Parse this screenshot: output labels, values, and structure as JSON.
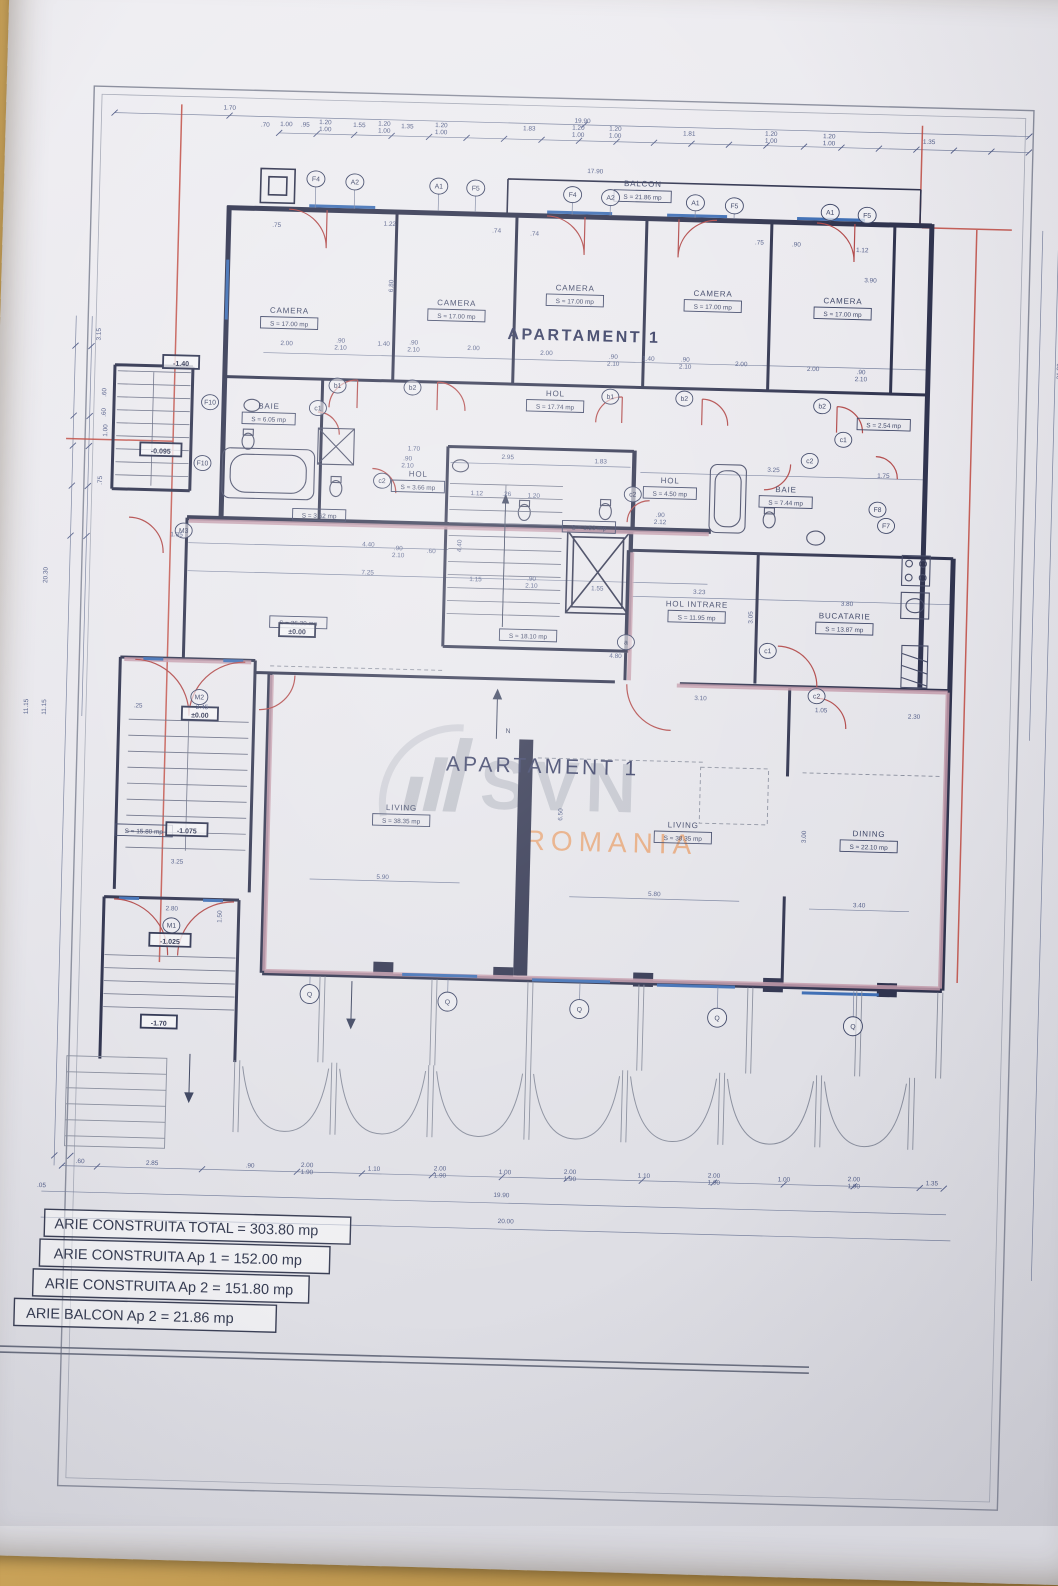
{
  "titles": {
    "upper": "APARTAMENT 1",
    "lower": "APARTAMENT 1"
  },
  "watermark": {
    "brand": "SVN",
    "region": "ROMANIA"
  },
  "compass": {
    "t": "N",
    "x": 492,
    "y": 706
  },
  "legend": [
    "ARIE CONSTRUITA TOTAL = 303.80 mp",
    "ARIE CONSTRUITA Ap 1 = 152.00 mp",
    "ARIE CONSTRUITA Ap 2 = 151.80 mp",
    "ARIE BALCON Ap 2 = 21.86 mp"
  ],
  "colors": {
    "wall": "#30344f",
    "door": "#b24a4a",
    "window": "#3f6fb5",
    "accent_wall": "#c49cab",
    "red_line": "#c0483e",
    "dim": "#55608a",
    "brand_gray": "#afb3bd",
    "brand_orange": "#e8873f"
  },
  "rooms": [
    {
      "n": "CAMERA",
      "a": "S = 17.00 mp",
      "x": 265,
      "y": 292
    },
    {
      "n": "CAMERA",
      "a": "S = 17.00 mp",
      "x": 432,
      "y": 280
    },
    {
      "n": "CAMERA",
      "a": "S = 17.00 mp",
      "x": 550,
      "y": 262
    },
    {
      "n": "CAMERA",
      "a": "S = 17.00 mp",
      "x": 688,
      "y": 264
    },
    {
      "n": "CAMERA",
      "a": "S = 17.00 mp",
      "x": 818,
      "y": 268
    },
    {
      "n": "BALCON",
      "a": "S = 21.86 mp",
      "x": 615,
      "y": 156
    },
    {
      "n": "HOL",
      "a": "S = 17.74 mp",
      "x": 533,
      "y": 368
    },
    {
      "n": "BAIE",
      "a": "S = 6.05 mp",
      "x": 247,
      "y": 388
    },
    {
      "n": "HOL",
      "a": "S = 3.66 mp",
      "x": 398,
      "y": 452
    },
    {
      "n": "",
      "a": "S = 3.62 mp",
      "x": 300,
      "y": 483
    },
    {
      "n": "",
      "a": "S = 2.54 mp",
      "x": 862,
      "y": 378
    },
    {
      "n": "HOL",
      "a": "S = 4.50 mp",
      "x": 650,
      "y": 452
    },
    {
      "n": "BAIE",
      "a": "S = 7.44 mp",
      "x": 766,
      "y": 458
    },
    {
      "n": "",
      "a": "S = 1.53 mp",
      "x": 570,
      "y": 488
    },
    {
      "n": "",
      "a": "S = 18.10 mp",
      "x": 512,
      "y": 598
    },
    {
      "n": "",
      "a": "S = 26.30 mp",
      "x": 282,
      "y": 591
    },
    {
      "n": "HOL INTRARE",
      "a": "S = 11.95 mp",
      "x": 680,
      "y": 575
    },
    {
      "n": "BUCATARIE",
      "a": "S = 13.87 mp",
      "x": 828,
      "y": 583
    },
    {
      "n": "LIVING",
      "a": "S = 38.35 mp",
      "x": 390,
      "y": 786
    },
    {
      "n": "LIVING",
      "a": "S = 38.35 mp",
      "x": 672,
      "y": 796
    },
    {
      "n": "DINING",
      "a": "S = 22.10 mp",
      "x": 858,
      "y": 800
    },
    {
      "n": "",
      "a": "S = 15.80 mp",
      "x": 133,
      "y": 803
    }
  ],
  "grid_bubbles": [
    {
      "t": "F4",
      "x": 288,
      "y": 157
    },
    {
      "t": "A2",
      "x": 327,
      "y": 159
    },
    {
      "t": "A1",
      "x": 411,
      "y": 161
    },
    {
      "t": "F5",
      "x": 448,
      "y": 162
    },
    {
      "t": "F4",
      "x": 545,
      "y": 166
    },
    {
      "t": "A2",
      "x": 583,
      "y": 168
    },
    {
      "t": "A1",
      "x": 668,
      "y": 171
    },
    {
      "t": "F5",
      "x": 707,
      "y": 173
    },
    {
      "t": "A1",
      "x": 803,
      "y": 177
    },
    {
      "t": "F5",
      "x": 840,
      "y": 179
    }
  ],
  "ref_bubbles": [
    {
      "t": "b1",
      "x": 315,
      "y": 363
    },
    {
      "t": "b2",
      "x": 390,
      "y": 363
    },
    {
      "t": "b1",
      "x": 588,
      "y": 367
    },
    {
      "t": "b2",
      "x": 662,
      "y": 367
    },
    {
      "t": "b2",
      "x": 800,
      "y": 371
    },
    {
      "t": "c1",
      "x": 296,
      "y": 386
    },
    {
      "t": "c2",
      "x": 362,
      "y": 457
    },
    {
      "t": "c1",
      "x": 822,
      "y": 404
    },
    {
      "t": "c2",
      "x": 789,
      "y": 426
    },
    {
      "t": "c2",
      "x": 613,
      "y": 464
    },
    {
      "t": "F8",
      "x": 858,
      "y": 473
    },
    {
      "t": "F7",
      "x": 867,
      "y": 489
    },
    {
      "t": "c1",
      "x": 752,
      "y": 617
    },
    {
      "t": "c2",
      "x": 802,
      "y": 661
    },
    {
      "t": "a",
      "x": 610,
      "y": 612
    },
    {
      "t": "F10",
      "x": 188,
      "y": 383
    },
    {
      "t": "F10",
      "x": 182,
      "y": 444
    },
    {
      "t": "M3",
      "x": 165,
      "y": 512
    },
    {
      "t": "M2",
      "x": 185,
      "y": 678
    },
    {
      "t": "M1",
      "x": 163,
      "y": 907
    }
  ],
  "q_bubbles": {
    "label": "Q",
    "positions": [
      [
        303,
        972
      ],
      [
        441,
        976
      ],
      [
        573,
        980
      ],
      [
        711,
        985
      ],
      [
        847,
        990
      ]
    ]
  },
  "elevations": [
    {
      "t": "-1.40",
      "x": 158,
      "y": 346
    },
    {
      "t": "-0.095",
      "x": 140,
      "y": 434
    },
    {
      "t": "±0.00",
      "x": 281,
      "y": 611
    },
    {
      "t": "±0.00",
      "x": 186,
      "y": 697
    },
    {
      "t": "-1.075",
      "x": 176,
      "y": 813
    },
    {
      "t": "-1.025",
      "x": 162,
      "y": 924
    },
    {
      "t": "-1.70",
      "x": 153,
      "y": 1006
    }
  ],
  "dims": [
    [
      "1.70",
      200,
      90
    ],
    [
      "19.90",
      553,
      94
    ],
    [
      ".70",
      236,
      106
    ],
    [
      "1.00",
      257,
      105
    ],
    [
      ".95",
      276,
      105
    ],
    [
      "1.20",
      296,
      102
    ],
    [
      "1.00",
      296,
      109
    ],
    [
      "1.55",
      330,
      104
    ],
    [
      "1.20",
      355,
      102
    ],
    [
      "1.00",
      355,
      109
    ],
    [
      "1.35",
      378,
      104
    ],
    [
      "1.20",
      412,
      102
    ],
    [
      "1.00",
      412,
      109
    ],
    [
      "1.83",
      500,
      103
    ],
    [
      "1.20",
      549,
      101
    ],
    [
      "1.00",
      549,
      108
    ],
    [
      "1.20",
      586,
      101
    ],
    [
      "1.00",
      586,
      108
    ],
    [
      "1.81",
      660,
      104
    ],
    [
      "1.20",
      742,
      102
    ],
    [
      "1.00",
      742,
      109
    ],
    [
      "1.20",
      800,
      103
    ],
    [
      "1.00",
      800,
      110
    ],
    [
      "1.35",
      900,
      106
    ],
    [
      "17.90",
      567,
      144
    ],
    [
      ".75",
      250,
      206
    ],
    [
      "1.22",
      363,
      202
    ],
    [
      ".74",
      470,
      206
    ],
    [
      ".74",
      508,
      208
    ],
    [
      ".75",
      733,
      211
    ],
    [
      ".90",
      770,
      212
    ],
    [
      "1.12",
      836,
      216
    ],
    [
      "3.90",
      845,
      246
    ],
    [
      "6.80",
      368,
      262,
      1
    ],
    [
      "2.00",
      263,
      324
    ],
    [
      ".90",
      317,
      320
    ],
    [
      "2.10",
      317,
      327
    ],
    [
      "1.40",
      360,
      322
    ],
    [
      ".90",
      390,
      320
    ],
    [
      "2.10",
      390,
      327
    ],
    [
      "2.00",
      450,
      324
    ],
    [
      "2.00",
      523,
      327
    ],
    [
      ".90",
      590,
      329
    ],
    [
      "2.10",
      590,
      336
    ],
    [
      "1.40",
      625,
      330
    ],
    [
      ".90",
      662,
      330
    ],
    [
      "2.10",
      662,
      337
    ],
    [
      "2.00",
      718,
      333
    ],
    [
      "2.00",
      790,
      336
    ],
    [
      ".90",
      838,
      338
    ],
    [
      "2.10",
      838,
      345
    ],
    [
      "1.70",
      393,
      426
    ],
    [
      ".90",
      387,
      436
    ],
    [
      "2.10",
      387,
      443
    ],
    [
      "2.95",
      487,
      432
    ],
    [
      "1.83",
      580,
      434
    ],
    [
      "3.25",
      753,
      438
    ],
    [
      "1.75",
      863,
      441
    ],
    [
      "1.12",
      457,
      469
    ],
    [
      ".26",
      487,
      469
    ],
    [
      "1.20",
      514,
      470
    ],
    [
      "4.40",
      443,
      520,
      1
    ],
    [
      "1.15",
      458,
      555
    ],
    [
      ".90",
      514,
      553
    ],
    [
      "2.10",
      514,
      560
    ],
    [
      "1.55",
      580,
      561
    ],
    [
      ".90",
      641,
      486
    ],
    [
      "2.12",
      641,
      493
    ],
    [
      "1.35",
      158,
      518
    ],
    [
      "4.40",
      350,
      523
    ],
    [
      "7.25",
      350,
      551
    ],
    [
      ".90",
      380,
      526
    ],
    [
      "2.10",
      380,
      533
    ],
    [
      ".60",
      413,
      528
    ],
    [
      "3.23",
      682,
      562
    ],
    [
      "3.80",
      830,
      570
    ],
    [
      "3.05",
      736,
      584,
      1
    ],
    [
      "4.80",
      600,
      628
    ],
    [
      "1.05",
      807,
      677
    ],
    [
      "2.30",
      900,
      681
    ],
    [
      "3.10",
      686,
      668
    ],
    [
      "2.45",
      188,
      690
    ],
    [
      ".25",
      124,
      690
    ],
    [
      "6.50",
      551,
      786,
      1
    ],
    [
      "3.00",
      795,
      802,
      1
    ],
    [
      "5.90",
      373,
      855
    ],
    [
      "5.80",
      645,
      865
    ],
    [
      "3.40",
      850,
      871
    ],
    [
      "3.25",
      167,
      845
    ],
    [
      "2.80",
      163,
      892
    ],
    [
      "1.50",
      213,
      897,
      1
    ],
    [
      "3.15",
      77,
      318,
      1
    ],
    [
      ".60",
      84,
      376,
      1
    ],
    [
      ".60",
      84,
      396,
      1
    ],
    [
      "1.00",
      86,
      414,
      1
    ],
    [
      ".75",
      82,
      464,
      1
    ],
    [
      "20.30",
      30,
      560,
      1
    ],
    [
      "11.15",
      14,
      692,
      1
    ],
    [
      "11.15",
      32,
      692,
      1
    ],
    [
      "21.30",
      1038,
      330,
      1
    ],
    [
      ".60",
      78,
      1147
    ],
    [
      "2.85",
      150,
      1147
    ],
    [
      ".90",
      248,
      1147
    ],
    [
      "2.00",
      305,
      1145
    ],
    [
      "1.90",
      305,
      1152
    ],
    [
      "1.10",
      372,
      1147
    ],
    [
      "2.00",
      438,
      1145
    ],
    [
      "1.90",
      438,
      1152
    ],
    [
      "1.00",
      503,
      1147
    ],
    [
      "2.00",
      568,
      1145
    ],
    [
      "1.90",
      568,
      1152
    ],
    [
      "1.10",
      642,
      1147
    ],
    [
      "2.00",
      712,
      1145
    ],
    [
      "1.90",
      712,
      1152
    ],
    [
      "1.00",
      782,
      1147
    ],
    [
      "2.00",
      852,
      1145
    ],
    [
      "1.90",
      852,
      1152
    ],
    [
      "1.35",
      930,
      1147
    ],
    [
      ".05",
      40,
      1172
    ],
    [
      "19.90",
      500,
      1170
    ],
    [
      "20.00",
      505,
      1196
    ]
  ]
}
